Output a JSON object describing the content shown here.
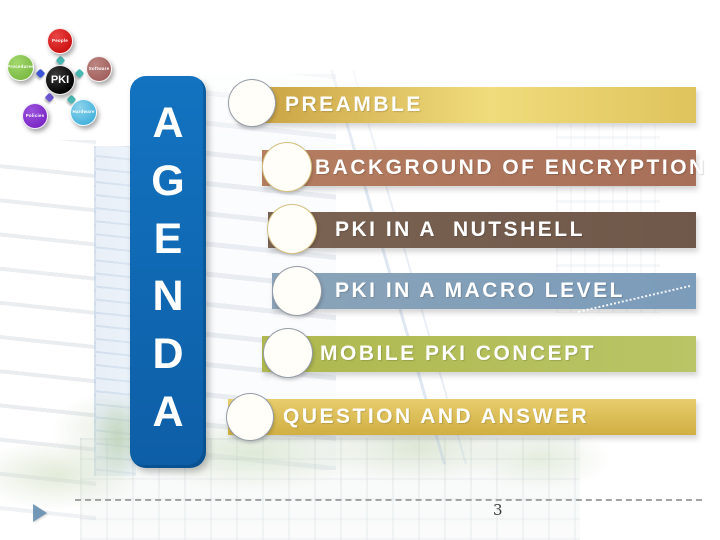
{
  "pki_diagram": {
    "center_label": "PKI",
    "center_color": "#000000",
    "satellites": [
      {
        "label": "People",
        "color": "#cc1111"
      },
      {
        "label": "Software",
        "color": "#a2615e"
      },
      {
        "label": "Procedures",
        "color": "#7cba45"
      },
      {
        "label": "Policies",
        "color": "#7a28c4"
      },
      {
        "label": "Hardware",
        "color": "#45b2dc"
      }
    ]
  },
  "agenda": {
    "letters": [
      "A",
      "G",
      "E",
      "N",
      "D",
      "A"
    ],
    "panel_color": "#0f67b1",
    "items": [
      {
        "label": "PREAMBLE",
        "color": "#ddbd55"
      },
      {
        "label": "BACKGROUND OF ENCRYPTION",
        "color": "#ab7257"
      },
      {
        "label": "PKI IN A  NUTSHELL",
        "color": "#725b4c"
      },
      {
        "label": "PKI IN A MACRO LEVEL",
        "color": "#83a0b8"
      },
      {
        "label": "MOBILE PKI CONCEPT",
        "color": "#b3bd55"
      },
      {
        "label": "QUESTION AND ANSWER",
        "color": "#dcbd52"
      }
    ]
  },
  "footer": {
    "page_number": "3"
  }
}
